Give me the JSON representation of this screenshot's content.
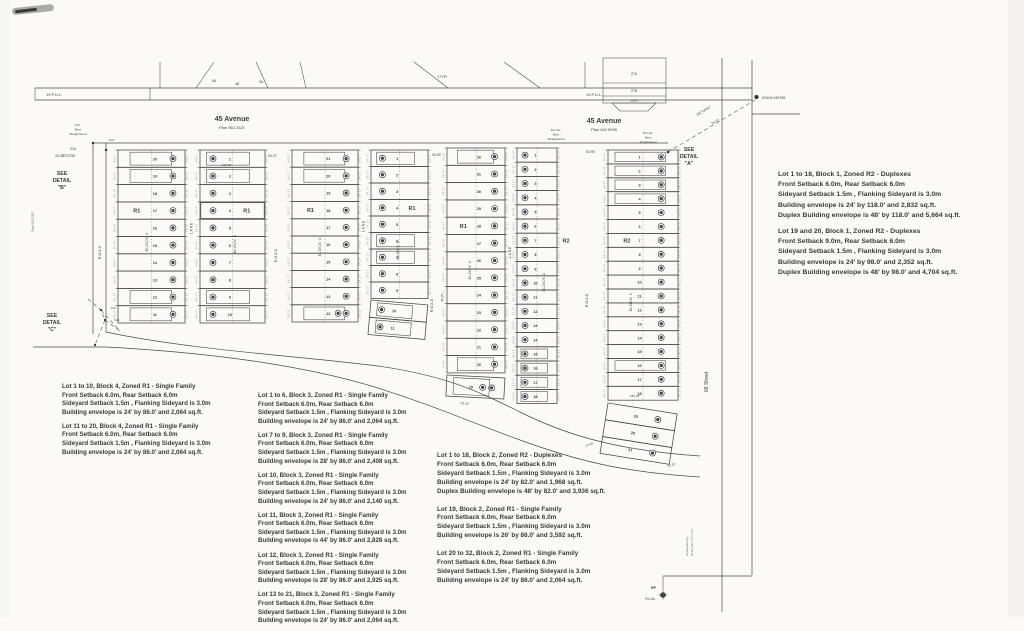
{
  "canvas": {
    "paper": "#fbfaf6",
    "ink": "#3d3d3d",
    "highlight_color": "#f2e73b"
  },
  "strip": {
    "pul_left": "19 P.U.L.",
    "pul_right": "19 P.U.L.",
    "parcels": [
      "9A",
      "4B",
      "9A"
    ],
    "yr": "17YR",
    "right_box": [
      "27A",
      "27B",
      "287B"
    ]
  },
  "avenues": {
    "west": {
      "name": "45 Avenue",
      "plan": "Plan 952 2327"
    },
    "east": {
      "name": "45 Avenue",
      "plan": "Plan 042 0095"
    }
  },
  "details": {
    "a": [
      "SEE",
      "DETAIL",
      "\"A\""
    ],
    "b": [
      "SEE",
      "DETAIL",
      "\"B\""
    ],
    "c": [
      "SEE",
      "DETAIL",
      "\"C\""
    ]
  },
  "monuments": {
    "ascm": "ASCM 945769",
    "rp": "RP",
    "rp_sub": "Fd.I.&c.",
    "fdi": "Fd.I.",
    "bent_east_1": [
      "Fd.I.&c.",
      "Bent",
      "Straightened"
    ],
    "bent_east_2": [
      "Fd.I.&c.",
      "Bent",
      "Straightened"
    ],
    "bent_west": [
      "Fd.I.",
      "Bent",
      "Straightened"
    ]
  },
  "bearings": {
    "line": "242°30'52\"",
    "dist": "79.73",
    "west_angle": "33°10'35\"",
    "west_dist": "9.54"
  },
  "streets": {
    "s68": "68 Street",
    "roadwidening": [
      "Roadwidening",
      "Road Plan 772 2719"
    ],
    "west_plan": "Plan 952 2327",
    "road": "ROAD",
    "lane": "LANE"
  },
  "dims": [
    "33.29'",
    "33.27'",
    "33.09'",
    "53.95'",
    "131.62'",
    "150.92'",
    "111.82'",
    "27.49'",
    "21.23'",
    "45.75'"
  ],
  "edge_dim": "24.17",
  "blocks": [
    {
      "id": "block-4",
      "label": "BLOCK 4",
      "columns": [
        {
          "lots": [
            "20",
            "19",
            "18",
            "17",
            "16",
            "15",
            "14",
            "13",
            "12",
            "11"
          ],
          "zone": "R1",
          "zone_row": 3
        },
        {
          "lots": [
            "1",
            "2",
            "3",
            "4",
            "5",
            "6",
            "7",
            "8",
            "9",
            "10"
          ],
          "zone": "R1",
          "zone_row": 3,
          "highlight_lot": "4"
        }
      ]
    },
    {
      "id": "block-3",
      "label": "BLOCK 3",
      "columns": [
        {
          "lots": [
            "21",
            "20",
            "19",
            "18",
            "17",
            "16",
            "15",
            "14",
            "13",
            "12"
          ],
          "zone": "R1",
          "zone_row": 3
        },
        {
          "lots": [
            "1",
            "2",
            "3",
            "4",
            "5",
            "6",
            "7",
            "8",
            "9"
          ],
          "zone": "R1",
          "zone_row": 3
        }
      ],
      "extra_lots": [
        "10",
        "11"
      ]
    },
    {
      "id": "block-2",
      "label": "BLOCK 2",
      "columns": [
        {
          "lots": [
            "32",
            "31",
            "30",
            "29",
            "28",
            "27",
            "26",
            "25",
            "24",
            "23",
            "22",
            "21",
            "20"
          ],
          "zone": "R1",
          "zone_row": 4
        },
        {
          "lots": [
            "1",
            "2",
            "3",
            "4",
            "5",
            "6",
            "7",
            "8",
            "9",
            "10",
            "11",
            "12",
            "13",
            "14",
            "15",
            "16",
            "17",
            "18"
          ],
          "zone": "R2",
          "zone_row": 6
        }
      ],
      "extra_lots": [
        "19"
      ]
    },
    {
      "id": "block-1",
      "label": "BLOCK 1",
      "columns": [
        {
          "lots": [
            "1",
            "2",
            "3",
            "4",
            "5",
            "6",
            "7",
            "8",
            "9",
            "10",
            "11",
            "12",
            "13",
            "14",
            "15",
            "16",
            "17",
            "18"
          ],
          "zone": "R2",
          "zone_row": 6
        }
      ],
      "extra_lots": [
        "19",
        "20",
        "21"
      ]
    }
  ],
  "notes": {
    "left": [
      {
        "lines": [
          "Lot 1 to 10, Block 4, Zoned R1 - Single Family",
          "Front Setback 6.0m, Rear Setback 6.0m",
          "Sideyard Setback 1.5m , Flanking Sideyard is 3.0m",
          "Building envelope is 24' by 86.0'  and 2,064 sq.ft."
        ]
      },
      {
        "lines": [
          "Lot 11 to 20, Block 4, Zoned R1 - Single Family",
          "Front Setback 6.0m, Rear Setback 6.0m",
          "Sideyard Setback 1.5m , Flanking Sideyard is 3.0m",
          "Building envelope is 24' by 86.0'  and 2,064 sq.ft."
        ]
      }
    ],
    "middle": [
      {
        "lines": [
          "Lot 1 to 6, Block 3, Zoned R1 - Single Family",
          "Front Setback 6.0m, Rear Setback 6.0m",
          "Sideyard Setback 1.5m , Flanking Sideyard is 3.0m",
          "Building envelope is 24' by 86.0'  and 2,064 sq.ft."
        ]
      },
      {
        "lines": [
          "Lot 7 to 9, Block 3, Zoned R1 - Single Family",
          "Front Setback 6.0m, Rear Setback 6.0m",
          "Sideyard Setback 1.5m , Flanking Sideyard is 3.0m",
          "Building envelope is 28' by 86.0'  and 2,408 sq.ft."
        ]
      },
      {
        "lines": [
          "Lot 10, Block 3, Zoned R1 - Single Family",
          "Front Setback 6.0m, Rear Setback 6.0m",
          "Sideyard Setback 1.5m , Flanking Sideyard is 3.0m",
          "Building envelope is 24' by 86.0'  and 2,140 sq.ft."
        ]
      },
      {
        "lines": [
          "Lot 11, Block 3, Zoned R1 - Single Family",
          "Front Setback 6.0m, Rear Setback 6.0m",
          "Sideyard Setback 1.5m , Flanking Sideyard is 3.0m",
          "Building envelope is 44' by 86.0'  and 2,828 sq.ft."
        ]
      },
      {
        "lines": [
          "Lot 12, Block 3, Zoned R1 - Single Family",
          "Front Setback 6.0m, Rear Setback 6.0m",
          "Sideyard Setback 1.5m , Flanking Sideyard is 3.0m",
          "Building envelope is 28' by 86.0'  and 2,925 sq.ft."
        ]
      },
      {
        "lines": [
          "Lot 13 to 21, Block 3, Zoned R1 - Single Family",
          "Front Setback 6.0m, Rear Setback 6.0m",
          "Sideyard Setback 1.5m , Flanking Sideyard is 3.0m",
          "Building envelope is 24' by 86.0'  and 2,064 sq.ft."
        ]
      }
    ],
    "center": [
      {
        "lines": [
          "Lot 1 to 18, Block 2, Zoned R2 - Duplexes",
          "Front Setback 6.0m, Rear Setback 6.0m",
          "Sideyard Setback 1.5m , Flanking Sideyard is 3.0m",
          "Building envelope is 24' by 82.0'  and 1,968 sq.ft.",
          "Duplex Building envelope is 48' by 82.0'  and 3,936 sq.ft."
        ]
      },
      {
        "lines": [
          "Lot 19, Block 2, Zoned R1 - Single Family",
          "Front Setback 6.0m, Rear Setback 6.0m",
          "Sideyard Setback 1.5m , Flanking Sideyard is 3.0m",
          "Building envelope is 26' by 86.0'  and 3,592 sq.ft."
        ]
      },
      {
        "lines": [
          "Lot 20 to 32, Block 2, Zoned R1 - Single Family",
          "Front Setback 6.0m, Rear Setback 6.0m",
          "Sideyard Setback 1.5m , Flanking Sideyard is 3.0m",
          "Building envelope is 24' by 86.0'  and 2,064 sq.ft."
        ]
      }
    ],
    "right": [
      {
        "lines": [
          "Lot 1 to 18, Block 1, Zoned R2 - Duplexes",
          "Front Setback 6.0m, Rear Setback 6.0m",
          "Sideyard Setback 1.5m , Flanking Sideyard is 3.0m",
          "Building envelope is 24' by 118.0'  and 2,832 sq.ft.",
          "Duplex Building envelope is 48' by 118.0'  and 5,664 sq.ft."
        ]
      },
      {
        "lines": [
          "Lot 19 and 20, Block 1, Zoned R2 - Duplexes",
          "Front Setback 9.0m, Rear Setback 6.0m",
          "Sideyard Setback 1.5m , Flanking Sideyard is 3.0m",
          "Building envelope is 24' by 98.0'  and 2,352 sq.ft.",
          "Duplex Building envelope is 48' by 98.0'  and 4,704 sq.ft."
        ]
      }
    ]
  }
}
